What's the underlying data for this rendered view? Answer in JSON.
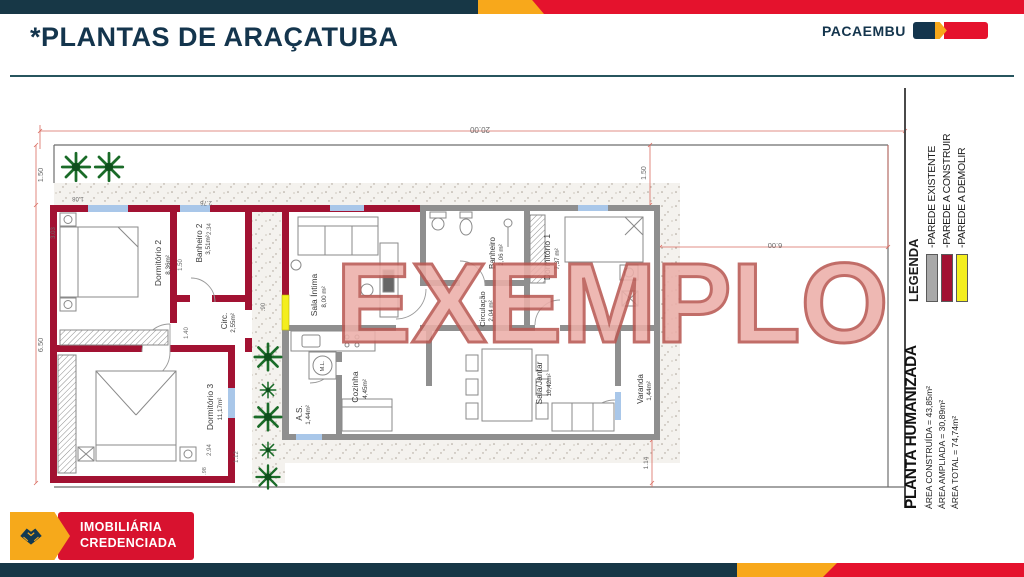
{
  "header": {
    "title": "*PLANTAS DE ARAÇATUBA",
    "brand": "PACAEMBU"
  },
  "watermark": "EXEMPLO",
  "plan": {
    "rooms": [
      {
        "name": "Dormitório 2",
        "area": "8,36m²"
      },
      {
        "name": "Banheiro 2",
        "area": "3,51m²"
      },
      {
        "name": "Circ.",
        "area": "2,55m²"
      },
      {
        "name": "Dormitório 3",
        "area": "11,17m²"
      },
      {
        "name": "Sala Íntima",
        "area": "8,00 m²"
      },
      {
        "name": "Banheiro",
        "area": "2,06 m²"
      },
      {
        "name": "Circulação",
        "area": "2,04 m²"
      },
      {
        "name": "Dormitório 1",
        "area": "7,37 m²"
      },
      {
        "name": "A.S.",
        "area": "1,44m²"
      },
      {
        "name": "Cozinha",
        "area": "4,45m²"
      },
      {
        "name": "Sala/Jantar",
        "area": "10,42m²"
      },
      {
        "name": "Varanda",
        "area": "1,44m²"
      }
    ],
    "appliance_label": "M.L.",
    "dimensions": {
      "lot_width": "20.00",
      "front_setback": "1.50",
      "lot_depth_left": "6.50",
      "right_setback": "1.50",
      "right_yard_width": "6.00",
      "d_108": "1.08",
      "d_303": "3.03",
      "d_276": "2.76",
      "d_234": "2.34",
      "bath2_width": "1.50",
      "d_140": "1.40",
      "d_294": "2.94",
      "d_112": "1.12",
      "d_098": ".98",
      "d_090": ".90",
      "d_114": "1.14"
    }
  },
  "legend": {
    "title": "LEGENDA",
    "items": [
      {
        "label": "-PAREDE EXISTENTE",
        "color": "#a9a9a9"
      },
      {
        "label": "-PAREDE A CONSTRUIR",
        "color": "#a21232"
      },
      {
        "label": "-PAREDE A DEMOLIR",
        "color": "#f4ee1f"
      }
    ]
  },
  "title_block": {
    "title": "PLANTA HUMANIZADA",
    "area_built": "ÁREA CONSTRUÍDA = 43,85m²",
    "area_expanded": "ÁREA AMPLIADA = 30,89m²",
    "area_total": "ÁREA TOTAL = 74,74m²"
  },
  "footer": {
    "badge_line1": "IMOBILIÁRIA",
    "badge_line2": "CREDENCIADA"
  },
  "colors": {
    "brand_teal": "#173746",
    "brand_yellow": "#f8a81b",
    "brand_red": "#e5122d",
    "wall_new": "#a21232",
    "wall_existing": "#8f8f8f",
    "wall_demolish": "#f4ee1f",
    "window_blue": "#a9c7e9",
    "watermark_fill": "#ecafa9",
    "watermark_stroke": "#b95a54"
  }
}
